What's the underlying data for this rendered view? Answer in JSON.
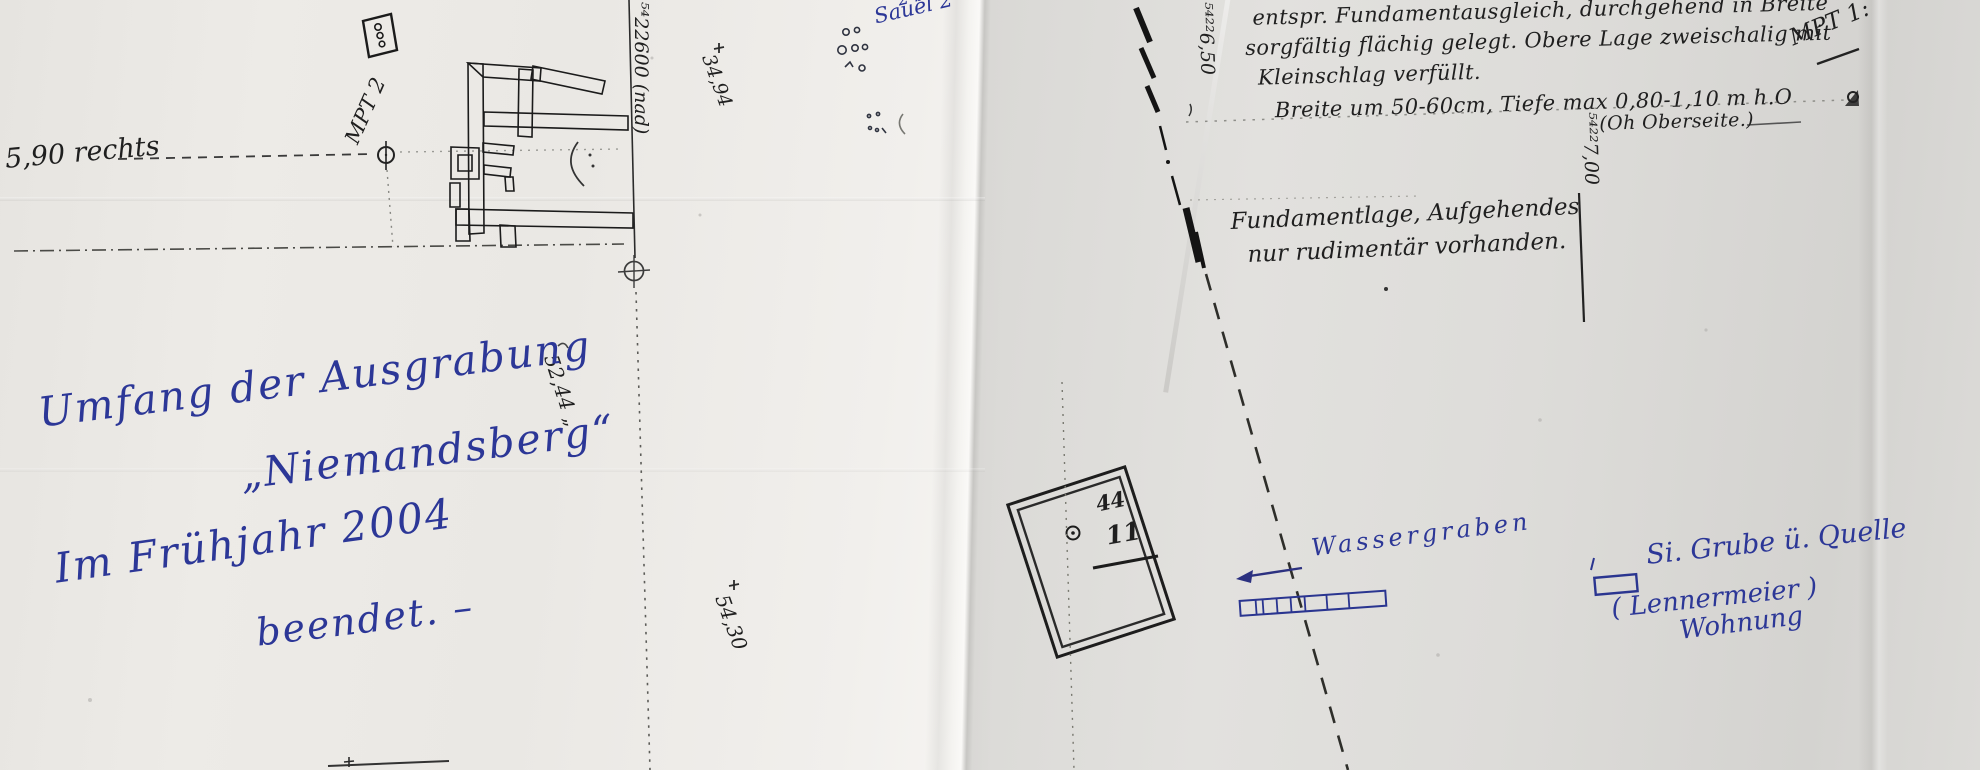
{
  "colors": {
    "paper_left": "#eceae6",
    "paper_right": "#dcdbd8",
    "ink_black": "#1f1f1f",
    "ink_blue": "#2c3797"
  },
  "left_sheet": {
    "elevation_note": "5,90 rechts",
    "survey_point_label": "MPT 2",
    "grid_label_600": "⁵⁴22600 (nad)",
    "dim_34": "34,94",
    "dim_52": "52,44 „",
    "dim_54": "54,30",
    "blue_fragment": "2 ba",
    "saal_label": "Sauel 2",
    "excavation_note": {
      "l1": "Umfang der Ausgrabung",
      "l2": "„Niemandsberg“",
      "l3": "Im Frühjahr 2004",
      "l4": "beendet. –"
    }
  },
  "right_sheet": {
    "grid_label_650": "⁵⁴²²6,50",
    "grid_label_700": "⁵⁴²²7,00",
    "survey_point_label": "MPT 1:",
    "construction_note": {
      "l1": "entspr. Fundamentausgleich, durchgehend in Breite",
      "l2": "sorgfältig flächig gelegt. Obere Lage zweischalig mit",
      "l3": "Kleinschlag verfüllt.",
      "l4": "Breite um 50-60cm, Tiefe max 0,80-1,10 m h.O",
      "l5": "(Oh Oberseite.)"
    },
    "foundation_note": {
      "l1": "Fundamentlage, Aufgehendes",
      "l2": "nur rudimentär vorhanden."
    },
    "feature": {
      "upper": "44",
      "lower": "11"
    },
    "water_ditch_label": "Wassergraben",
    "spring_note": {
      "l1": "Si. Grube ü. Quelle",
      "l2": "( Lennermeier )",
      "l3": "Wohnung"
    }
  }
}
